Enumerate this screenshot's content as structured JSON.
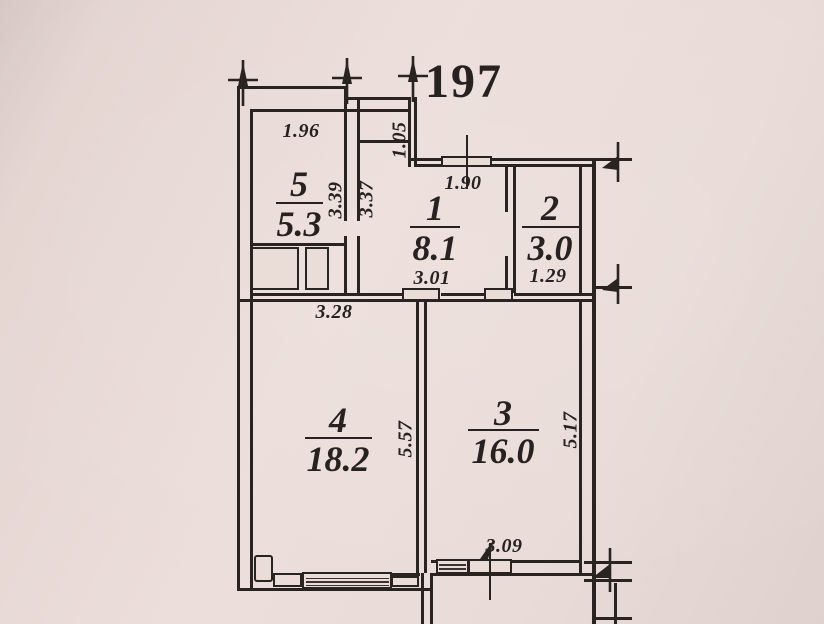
{
  "plan": {
    "apartment_number": "197",
    "rooms": [
      {
        "number": "5",
        "area": "5.3"
      },
      {
        "number": "1",
        "area": "8.1"
      },
      {
        "number": "2",
        "area": "3.0"
      },
      {
        "number": "4",
        "area": "18.2"
      },
      {
        "number": "3",
        "area": "16.0"
      }
    ],
    "dimensions": {
      "room5_top_width": "1.96",
      "niche_height": "1.05",
      "room5_height": "3.39",
      "room1_left_height": "3.37",
      "room1_top_width": "1.90",
      "room1_width": "3.01",
      "room2_width": "1.29",
      "hall_width": "3.28",
      "room4_height": "5.57",
      "room3_height": "5.17",
      "room3_width": "3.09"
    },
    "colors": {
      "paper": "#e9dbd6",
      "ink": "#272220"
    }
  }
}
